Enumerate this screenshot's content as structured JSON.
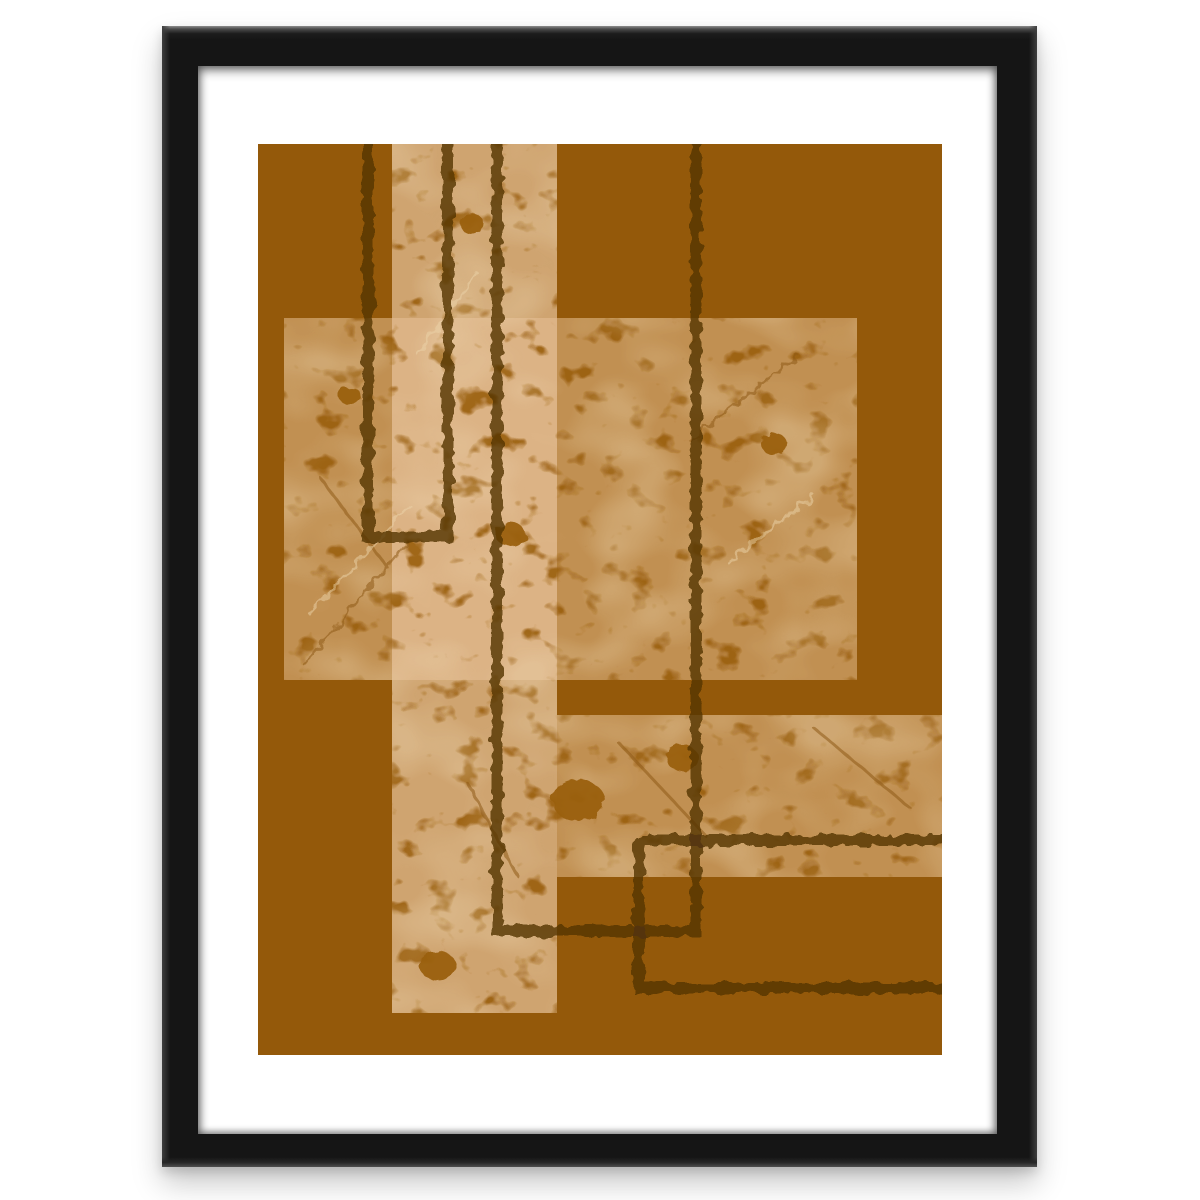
{
  "page": {
    "background": "#ffffff"
  },
  "frame": {
    "outer": {
      "left": 162,
      "top": 26,
      "width": 875,
      "height": 1141
    },
    "border": {
      "top": 40,
      "right": 40,
      "bottom": 33,
      "left": 36
    },
    "color": "#151515"
  },
  "mat": {
    "color": "#ffffff"
  },
  "artwork": {
    "offset": {
      "left": 60,
      "top": 78
    },
    "size": {
      "width": 684,
      "height": 911
    },
    "background": "#94590A",
    "texture_rects": [
      {
        "name": "middle-rect",
        "x": 26,
        "y": 174,
        "width": 573,
        "height": 362,
        "fill": "rgba(206,160,102,0.78)"
      },
      {
        "name": "lower-band",
        "x": 299,
        "y": 571,
        "width": 385,
        "height": 162,
        "fill": "rgba(206,160,102,0.78)"
      },
      {
        "name": "tall-column",
        "x": 134,
        "y": 0,
        "width": 165,
        "height": 869,
        "fill": "rgba(230,192,152,0.72)"
      }
    ],
    "outlines": {
      "stroke": "rgba(84,51,8,0.80)",
      "width": 11,
      "paths": [
        {
          "name": "narrow-u-outline",
          "d": "M110,-12 V393 H190 V-12"
        },
        {
          "name": "wide-u-outline",
          "d": "M239,-12 V787 H438 V-12"
        },
        {
          "name": "clipped-rect-outline",
          "d": "M700,696 H381 V844 H700"
        }
      ]
    },
    "speckle": {
      "color": "#9A5F10",
      "opacity": 0.9
    },
    "mottle": {
      "color": "#F2DFBC",
      "opacity": 0.3
    },
    "blobs": [
      [
        320,
        656,
        26
      ],
      [
        252,
        390,
        15
      ],
      [
        180,
        822,
        18
      ],
      [
        516,
        300,
        13
      ],
      [
        92,
        252,
        11
      ],
      [
        424,
        614,
        16
      ],
      [
        214,
        80,
        12
      ]
    ],
    "scratches": {
      "dark": {
        "stroke": "#8F5A14",
        "width": 3,
        "opacity": 0.55,
        "lines": [
          [
            46,
            520,
            150,
            398
          ],
          [
            64,
            336,
            130,
            424
          ],
          [
            432,
            296,
            540,
            212
          ],
          [
            362,
            600,
            448,
            692
          ],
          [
            556,
            584,
            652,
            664
          ],
          [
            210,
            640,
            258,
            730
          ]
        ]
      },
      "light": {
        "stroke": "#EBD4AA",
        "width": 3,
        "opacity": 0.5,
        "lines": [
          [
            52,
            470,
            152,
            362
          ],
          [
            470,
            418,
            556,
            352
          ],
          [
            160,
            210,
            220,
            130
          ]
        ]
      }
    }
  }
}
